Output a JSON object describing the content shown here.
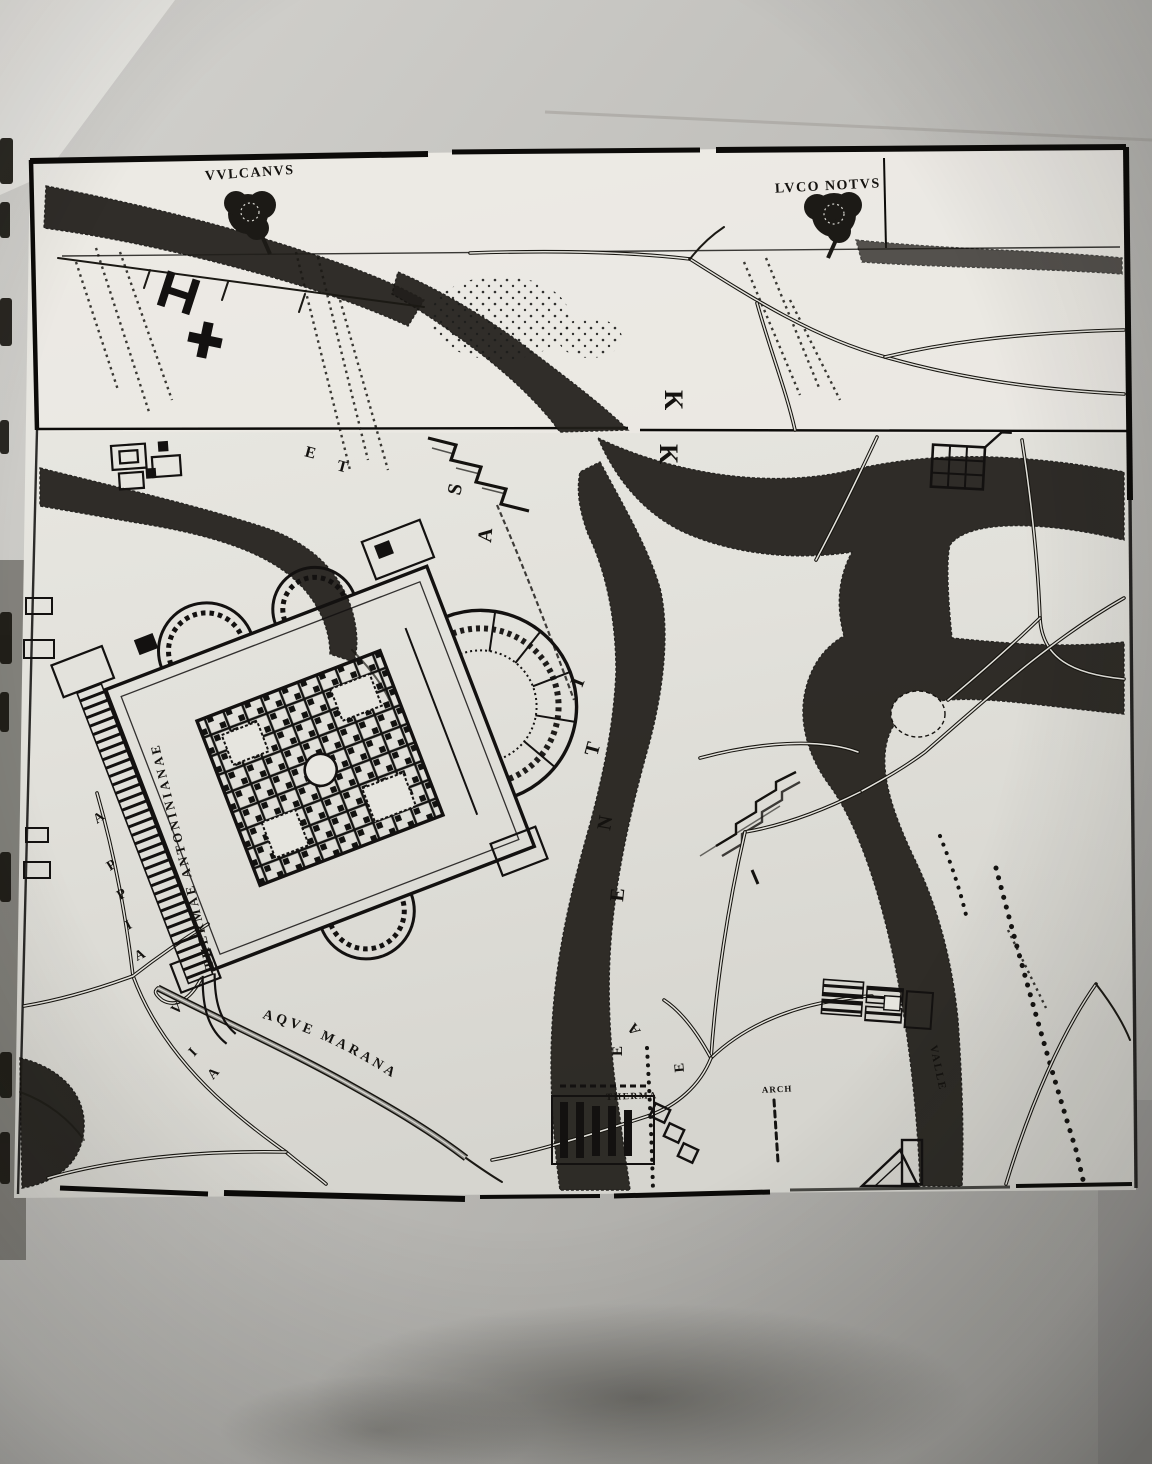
{
  "colors": {
    "photo_background": "#b7b6b2",
    "sheet": "#e6e5df",
    "ink": "#131110",
    "valley_shade": "#26231e"
  },
  "map": {
    "tree_label_left": "VVLCANVS",
    "tree_label_right": "LVCO NOTVS",
    "register_marks": [
      "K",
      "K"
    ],
    "hill_letters": [
      "S",
      "A",
      "I",
      "T",
      "N",
      "E"
    ],
    "valley_letters": [
      "A",
      "E",
      "E"
    ],
    "corner_letters": [
      "E",
      "T"
    ],
    "labels": {
      "thermae": "THERMAE ANTONINIANAE",
      "appia_upper": [
        "A",
        "P",
        "P",
        "I",
        "A"
      ],
      "appia_lower": [
        "V",
        "I",
        "A"
      ],
      "marana": "AQVE MARANA",
      "therma_small": "THERMA",
      "arch_small": "ARCH",
      "valle_small": "VALLE"
    }
  }
}
